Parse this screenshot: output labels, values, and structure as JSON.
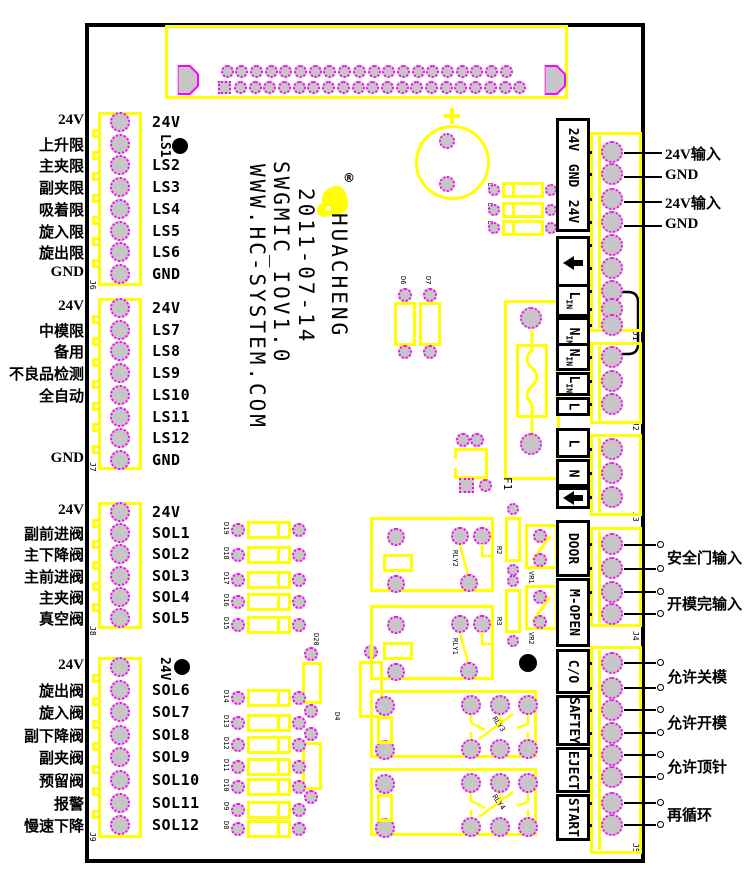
{
  "colors": {
    "silk_yellow": "#ffff00",
    "pad_fill": "#c6c6c6",
    "pad_ring": "#ff00ff",
    "ink": "#000000"
  },
  "silkscreen": {
    "brand": "HUACHENG",
    "registered": "®",
    "date": "2011-07-14",
    "model": "SWGMIC_IOV1.0",
    "website": "WWW.HC-SYSTEM.COM"
  },
  "left_groups": [
    {
      "connector": "J6",
      "rows": [
        {
          "ext": "24V",
          "int": "24V"
        },
        {
          "ext": "上升限",
          "int": "LS1",
          "v": true,
          "dot": true
        },
        {
          "ext": "主夹限",
          "int": "LS2"
        },
        {
          "ext": "副夹限",
          "int": "LS3"
        },
        {
          "ext": "吸着限",
          "int": "LS4"
        },
        {
          "ext": "旋入限",
          "int": "LS5"
        },
        {
          "ext": "旋出限",
          "int": "LS6"
        },
        {
          "ext": "GND",
          "int": "GND"
        }
      ]
    },
    {
      "connector": "J7",
      "rows": [
        {
          "ext": "24V",
          "int": "24V"
        },
        {
          "ext": "中模限",
          "int": "LS7"
        },
        {
          "ext": "备用",
          "int": "LS8"
        },
        {
          "ext": "不良品检测",
          "int": "LS9"
        },
        {
          "ext": "全自动",
          "int": "LS10"
        },
        {
          "ext": "",
          "int": "LS11"
        },
        {
          "ext": "",
          "int": "LS12"
        },
        {
          "ext": "GND",
          "int": "GND"
        }
      ]
    },
    {
      "connector": "J8",
      "rows": [
        {
          "ext": "24V",
          "int": "24V"
        },
        {
          "ext": "副前进阀",
          "int": "SOL1"
        },
        {
          "ext": "主下降阀",
          "int": "SOL2"
        },
        {
          "ext": "主前进阀",
          "int": "SOL3"
        },
        {
          "ext": "主夹阀",
          "int": "SOL4"
        },
        {
          "ext": "真空阀",
          "int": "SOL5"
        }
      ]
    },
    {
      "connector": "J9",
      "rows": [
        {
          "ext": "24V",
          "int": "24V",
          "v": true,
          "dot": true
        },
        {
          "ext": "旋出阀",
          "int": "SOL6"
        },
        {
          "ext": "旋入阀",
          "int": "SOL7"
        },
        {
          "ext": "副下降阀",
          "int": "SOL8"
        },
        {
          "ext": "副夹阀",
          "int": "SOL9"
        },
        {
          "ext": "预留阀",
          "int": "SOL10"
        },
        {
          "ext": "报警",
          "int": "SOL11"
        },
        {
          "ext": "慢速下降",
          "int": "SOL12"
        }
      ]
    }
  ],
  "right_side": {
    "power_labels": [
      "24V输入",
      "GND",
      "24V输入",
      "GND"
    ],
    "io_labels": [
      "安全门输入",
      "开模完输入",
      "允许关模",
      "允许开模",
      "允许顶针",
      "再循环"
    ],
    "side_boxes": [
      {
        "kind": "power",
        "labels": [
          "24V",
          "GND",
          "24V"
        ]
      },
      {
        "kind": "arrow"
      },
      {
        "kind": "sub",
        "m": "L",
        "s": "IN"
      },
      {
        "kind": "sub",
        "m": "N",
        "s": "IN"
      },
      {
        "kind": "sub",
        "m": "N",
        "s": "IN"
      },
      {
        "kind": "sub",
        "m": "L",
        "s": "IN"
      },
      {
        "kind": "plain",
        "label": "L"
      },
      {
        "kind": "plain",
        "label": "L"
      },
      {
        "kind": "plain",
        "label": "N"
      },
      {
        "kind": "arrow"
      },
      {
        "kind": "plain",
        "label": "DOOR"
      },
      {
        "kind": "plain",
        "label": "M-OPEN"
      },
      {
        "kind": "plain",
        "label": "C/O"
      },
      {
        "kind": "plain",
        "label": "SAFTEY"
      },
      {
        "kind": "plain",
        "label": "EJECT"
      },
      {
        "kind": "plain",
        "label": "START"
      }
    ],
    "connectors": [
      "J1",
      "J2",
      "J3",
      "J4",
      "J5"
    ]
  },
  "components": {
    "fuse": "F1",
    "relays": [
      "RLY2",
      "RLY1",
      "RLY3",
      "RLY4"
    ],
    "d_top": [
      "D1",
      "D2",
      "D3"
    ],
    "d_pair": [
      "D6",
      "D7"
    ],
    "sol_a": [
      "D19",
      "D18",
      "D17",
      "D16",
      "D15"
    ],
    "sol_b": [
      "D14",
      "D13",
      "D12",
      "D11",
      "D10",
      "D9",
      "D8"
    ],
    "d20": "D20",
    "d4": "D4",
    "r": [
      "R2",
      "R3"
    ],
    "vr": [
      "VR1",
      "VR2"
    ]
  }
}
